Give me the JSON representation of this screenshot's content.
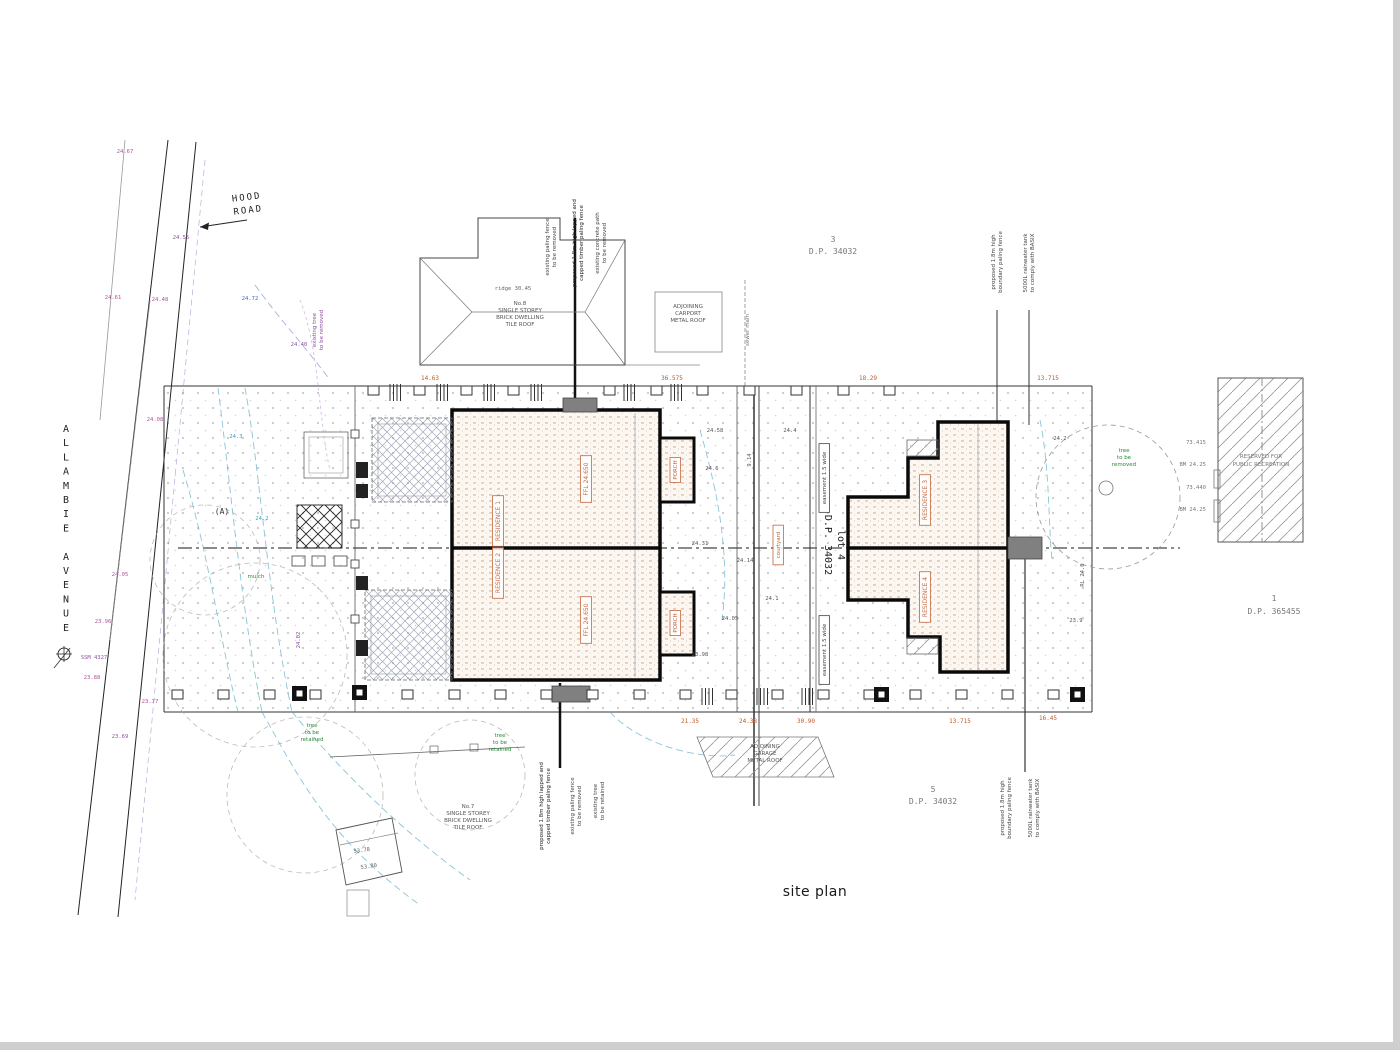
{
  "title": {
    "text": "site plan"
  },
  "streets": {
    "avenue": "ALLAMBIE AVENUE"
  },
  "colors": {
    "outline": "#0a0a0a",
    "orange": "#c05a28",
    "unit_label": "#c2683f",
    "magenta": "#b0509a",
    "purple": "#8a4f9e",
    "green": "#2a8a3a",
    "cyan": "#3aa0b8",
    "gray": "#555555"
  },
  "blocks": [
    {
      "n": "street-name-allambie-avenue",
      "lines": [
        "A",
        "L",
        "L",
        "A",
        "M",
        "B",
        "I",
        "E",
        " ",
        "A",
        "V",
        "E",
        "N",
        "U",
        "E"
      ],
      "x": 66,
      "y": 432,
      "s": 10,
      "lh": 14.2,
      "c": "#222",
      "f": "mono"
    },
    {
      "n": "road-name",
      "lines": [
        "HOOD",
        "ROAD"
      ],
      "x": 247,
      "y": 200,
      "s": 9,
      "lh": 13,
      "c": "#222",
      "r": -7,
      "ls": 2,
      "f": "mono"
    },
    {
      "n": "lot-3-label",
      "lines": [
        "3",
        "D.P. 34032"
      ],
      "x": 833,
      "y": 242,
      "s": 8,
      "lh": 12,
      "c": "#777",
      "f": "mono"
    },
    {
      "n": "lot-5-label",
      "lines": [
        "5",
        "D.P. 34032"
      ],
      "x": 933,
      "y": 792,
      "s": 8,
      "lh": 12,
      "c": "#777",
      "f": "mono"
    },
    {
      "n": "lot-1-label",
      "lines": [
        "1",
        "D.P. 365455"
      ],
      "x": 1274,
      "y": 601,
      "s": 8,
      "lh": 13,
      "c": "#777",
      "f": "mono"
    },
    {
      "n": "lot-4-label",
      "lines": [
        "lot 4",
        "D.P. 34032"
      ],
      "x": 838,
      "y": 545,
      "s": 10,
      "lh": 13,
      "c": "#222",
      "r": 90,
      "f": "mono"
    },
    {
      "n": "house-no8-label",
      "lines": [
        "No.8",
        "SINGLE STOREY",
        "BRICK DWELLING",
        "TILE ROOF"
      ],
      "x": 520,
      "y": 305,
      "s": 5.5,
      "lh": 7,
      "c": "#555"
    },
    {
      "n": "carport-label",
      "lines": [
        "ADJOINING",
        "CARPORT",
        "METAL ROOF"
      ],
      "x": 688,
      "y": 308,
      "s": 5.5,
      "lh": 7,
      "c": "#555"
    },
    {
      "n": "neighbour-garage-label",
      "lines": [
        "ADJOINING",
        "GARAGE",
        "METAL ROOF"
      ],
      "x": 765,
      "y": 748,
      "s": 5.5,
      "lh": 7,
      "c": "#555"
    },
    {
      "n": "house-no7-label",
      "lines": [
        "No.7",
        "SINGLE STOREY",
        "BRICK DWELLING",
        "TILE ROOF"
      ],
      "x": 468,
      "y": 808,
      "s": 5.5,
      "lh": 7,
      "c": "#555"
    },
    {
      "n": "reserve-label",
      "lines": [
        "RESERVED FOR",
        "PUBLIC RECREATION"
      ],
      "x": 1261,
      "y": 458,
      "s": 5.5,
      "lh": 8,
      "c": "#777"
    },
    {
      "n": "tree-label-1",
      "lines": [
        "tree",
        "to be",
        "removed"
      ],
      "x": 1124,
      "y": 452,
      "s": 5.5,
      "lh": 7,
      "c": "#2a8a3a"
    },
    {
      "n": "tree-label-2",
      "lines": [
        "tree",
        "to be",
        "retained"
      ],
      "x": 312,
      "y": 727,
      "s": 5.5,
      "lh": 7,
      "c": "#2a8a3a"
    },
    {
      "n": "tree-label-3",
      "lines": [
        "tree",
        "to be",
        "retained"
      ],
      "x": 500,
      "y": 737,
      "s": 5.5,
      "lh": 7,
      "c": "#2a8a3a"
    },
    {
      "n": "annotation-fence-top-1",
      "lines": [
        "existing paling fence",
        "to be removed"
      ],
      "x": 549,
      "y": 247,
      "s": 5.5,
      "lh": 7,
      "c": "#444",
      "r": -90
    },
    {
      "n": "annotation-fence-top-2",
      "lines": [
        "proposed 1.8m high lapped and",
        "capped timber paling fence"
      ],
      "x": 576,
      "y": 243,
      "s": 5.5,
      "lh": 7,
      "c": "#222",
      "r": -90
    },
    {
      "n": "annotation-path-top",
      "lines": [
        "existing concrete path",
        "to be removed"
      ],
      "x": 599,
      "y": 243,
      "s": 5.5,
      "lh": 7,
      "c": "#444",
      "r": -90
    },
    {
      "n": "annotation-fence-ne-1",
      "lines": [
        "proposed 1.8m high",
        "boundary paling fence"
      ],
      "x": 995,
      "y": 262,
      "s": 5.5,
      "lh": 7,
      "c": "#444",
      "r": -90
    },
    {
      "n": "annotation-tank-ne",
      "lines": [
        "5000L rainwater tank",
        "to comply with BASIX"
      ],
      "x": 1027,
      "y": 263,
      "s": 5.5,
      "lh": 7,
      "c": "#444",
      "r": -90
    },
    {
      "n": "annotation-fence-sw-1",
      "lines": [
        "proposed 1.8m high lapped and",
        "capped timber paling fence"
      ],
      "x": 543,
      "y": 806,
      "s": 5.5,
      "lh": 7,
      "c": "#222",
      "r": -90
    },
    {
      "n": "annotation-fence-sw-2",
      "lines": [
        "existing paling fence",
        "to be removed"
      ],
      "x": 574,
      "y": 806,
      "s": 5.5,
      "lh": 7,
      "c": "#444",
      "r": -90
    },
    {
      "n": "annotation-tree-sw",
      "lines": [
        "existing tree",
        "to be retained"
      ],
      "x": 597,
      "y": 801,
      "s": 5.5,
      "lh": 7,
      "c": "#444",
      "r": -90
    },
    {
      "n": "annotation-fence-se-1",
      "lines": [
        "proposed 1.8m high",
        "boundary paling fence"
      ],
      "x": 1004,
      "y": 808,
      "s": 5.5,
      "lh": 7,
      "c": "#444",
      "r": -90
    },
    {
      "n": "annotation-tank-se",
      "lines": [
        "5000L rainwater tank",
        "to comply with BASIX"
      ],
      "x": 1032,
      "y": 808,
      "s": 5.5,
      "lh": 7,
      "c": "#444",
      "r": -90
    },
    {
      "n": "annotation-tree-w",
      "lines": [
        "existing tree",
        "to be removed"
      ],
      "x": 316,
      "y": 330,
      "s": 5.5,
      "lh": 7,
      "c": "#8a4f9e",
      "r": -90
    },
    {
      "n": "annotation-sewer",
      "lines": [
        "sewer main"
      ],
      "x": 749,
      "y": 330,
      "s": 5.5,
      "lh": 7,
      "c": "#777",
      "r": -90
    }
  ],
  "labels": [
    {
      "n": "dim",
      "t": "14.63",
      "x": 430,
      "y": 380,
      "c": "#c05a28",
      "s": 6,
      "f": "mono"
    },
    {
      "n": "dim",
      "t": "36.575",
      "x": 672,
      "y": 380,
      "c": "#c05a28",
      "s": 6,
      "f": "mono"
    },
    {
      "n": "dim",
      "t": "18.29",
      "x": 868,
      "y": 380,
      "c": "#c05a28",
      "s": 6,
      "f": "mono"
    },
    {
      "n": "dim",
      "t": "13.715",
      "x": 1048,
      "y": 380,
      "c": "#c05a28",
      "s": 6,
      "f": "mono"
    },
    {
      "n": "dim",
      "t": "21.35",
      "x": 690,
      "y": 723,
      "c": "#c05a28",
      "s": 6,
      "f": "mono"
    },
    {
      "n": "dim",
      "t": "24.38",
      "x": 748,
      "y": 723,
      "c": "#c05a28",
      "s": 6,
      "f": "mono"
    },
    {
      "n": "dim",
      "t": "30.90",
      "x": 806,
      "y": 723,
      "c": "#c05a28",
      "s": 6,
      "f": "mono"
    },
    {
      "n": "dim",
      "t": "13.715",
      "x": 960,
      "y": 723,
      "c": "#c05a28",
      "s": 6,
      "f": "mono"
    },
    {
      "n": "dim",
      "t": "16.45",
      "x": 1048,
      "y": 720,
      "c": "#c05a28",
      "s": 6,
      "f": "mono"
    },
    {
      "n": "dim",
      "t": "9.14",
      "x": 751,
      "y": 460,
      "c": "#555",
      "s": 5.5,
      "r": -90,
      "f": "mono"
    },
    {
      "n": "spot-level",
      "t": "24.58",
      "x": 715,
      "y": 432,
      "c": "#555",
      "s": 5.5,
      "f": "mono"
    },
    {
      "n": "spot-level",
      "t": "24.6",
      "x": 712,
      "y": 470,
      "c": "#555",
      "s": 5.5,
      "f": "mono"
    },
    {
      "n": "spot-level",
      "t": "24.31",
      "x": 700,
      "y": 545,
      "c": "#555",
      "s": 5.5,
      "f": "mono"
    },
    {
      "n": "spot-level",
      "t": "24.14",
      "x": 745,
      "y": 562,
      "c": "#555",
      "s": 5.5,
      "f": "mono"
    },
    {
      "n": "spot-level",
      "t": "24.05",
      "x": 730,
      "y": 620,
      "c": "#555",
      "s": 5.5,
      "f": "mono"
    },
    {
      "n": "spot-level",
      "t": "23.98",
      "x": 700,
      "y": 656,
      "c": "#555",
      "s": 5.5,
      "f": "mono"
    },
    {
      "n": "spot-level",
      "t": "24.1",
      "x": 772,
      "y": 600,
      "c": "#555",
      "s": 5.5,
      "f": "mono"
    },
    {
      "n": "spot-level",
      "t": "24.4",
      "x": 790,
      "y": 432,
      "c": "#555",
      "s": 5.5,
      "f": "mono"
    },
    {
      "n": "spot-level",
      "t": "24.2",
      "x": 1060,
      "y": 440,
      "c": "#555",
      "s": 5.5,
      "f": "mono"
    },
    {
      "n": "spot-level",
      "t": "23.9",
      "x": 1076,
      "y": 622,
      "c": "#555",
      "s": 5.5,
      "f": "mono"
    },
    {
      "n": "spot-level",
      "t": "RL 24.0",
      "x": 1084,
      "y": 575,
      "c": "#555",
      "s": 5.5,
      "r": -90,
      "f": "mono"
    },
    {
      "n": "spot-level",
      "t": "53.78",
      "x": 362,
      "y": 852,
      "c": "#666",
      "s": 5.5,
      "r": -8,
      "f": "mono"
    },
    {
      "n": "spot-level",
      "t": "53.80",
      "x": 369,
      "y": 868,
      "c": "#666",
      "s": 5.5,
      "r": -8,
      "f": "mono"
    },
    {
      "n": "bench-mark",
      "t": "73.415",
      "x": 1206,
      "y": 444,
      "c": "#777",
      "s": 5.5,
      "a": "end",
      "f": "mono"
    },
    {
      "n": "bench-mark",
      "t": "BM 24.25",
      "x": 1206,
      "y": 466,
      "c": "#777",
      "s": 5.5,
      "a": "end",
      "f": "mono"
    },
    {
      "n": "bench-mark",
      "t": "73.440",
      "x": 1206,
      "y": 489,
      "c": "#777",
      "s": 5.5,
      "a": "end",
      "f": "mono"
    },
    {
      "n": "bench-mark",
      "t": "BM 24.25",
      "x": 1206,
      "y": 511,
      "c": "#777",
      "s": 5.5,
      "a": "end",
      "f": "mono"
    },
    {
      "n": "point-a",
      "t": "(A)",
      "x": 222,
      "y": 514,
      "c": "#333",
      "s": 8,
      "f": "mono"
    },
    {
      "n": "survey-mark",
      "t": "SSM 4327",
      "x": 94,
      "y": 659,
      "c": "#8a4f9e",
      "s": 5.5,
      "f": "mono"
    },
    {
      "n": "ridge-level",
      "t": "ridge 30.45",
      "x": 513,
      "y": 290,
      "c": "#666",
      "s": 5.5,
      "f": "mono"
    },
    {
      "n": "road-level",
      "t": "24.67",
      "x": 125,
      "y": 153,
      "c": "#b0509a",
      "s": 5.5,
      "f": "mono"
    },
    {
      "n": "road-level",
      "t": "24.61",
      "x": 113,
      "y": 299,
      "c": "#b0509a",
      "s": 5.5,
      "f": "mono"
    },
    {
      "n": "road-level",
      "t": "24.55",
      "x": 181,
      "y": 239,
      "c": "#8a4f9e",
      "s": 5.5,
      "f": "mono"
    },
    {
      "n": "road-level",
      "t": "24.48",
      "x": 160,
      "y": 301,
      "c": "#b0509a",
      "s": 5.5,
      "f": "mono"
    },
    {
      "n": "road-level",
      "t": "24.40",
      "x": 299,
      "y": 346,
      "c": "#8a4f9e",
      "s": 5.5,
      "f": "mono"
    },
    {
      "n": "road-level",
      "t": "24.72",
      "x": 250,
      "y": 300,
      "c": "#3a6fba",
      "s": 5.5,
      "f": "mono"
    },
    {
      "n": "road-level",
      "t": "24.08",
      "x": 155,
      "y": 421,
      "c": "#b0509a",
      "s": 5.5,
      "f": "mono"
    },
    {
      "n": "road-level",
      "t": "24.05",
      "x": 120,
      "y": 576,
      "c": "#b0509a",
      "s": 5.5,
      "f": "mono"
    },
    {
      "n": "road-level",
      "t": "23.96",
      "x": 103,
      "y": 623,
      "c": "#b0509a",
      "s": 5.5,
      "f": "mono"
    },
    {
      "n": "road-level",
      "t": "23.88",
      "x": 92,
      "y": 679,
      "c": "#b0509a",
      "s": 5.5,
      "f": "mono"
    },
    {
      "n": "road-level",
      "t": "23.77",
      "x": 150,
      "y": 703,
      "c": "#b0509a",
      "s": 5.5,
      "f": "mono"
    },
    {
      "n": "road-level",
      "t": "23.69",
      "x": 120,
      "y": 738,
      "c": "#8a4f9e",
      "s": 5.5,
      "f": "mono"
    },
    {
      "n": "road-level",
      "t": "24.02",
      "x": 300,
      "y": 640,
      "c": "#8a4f9e",
      "s": 5.5,
      "r": -90,
      "f": "mono"
    },
    {
      "n": "contour-value",
      "t": "24.3",
      "x": 236,
      "y": 438,
      "c": "#3aa0b8",
      "s": 5.5,
      "f": "mono"
    },
    {
      "n": "contour-value",
      "t": "24.2",
      "x": 262,
      "y": 520,
      "c": "#3aa0b8",
      "s": 5.5,
      "f": "mono"
    },
    {
      "n": "landscape-note",
      "t": "mulch",
      "x": 256,
      "y": 578,
      "c": "#2a8a3a",
      "s": 5.5
    }
  ],
  "boxed": [
    {
      "n": "unit-label-residence-1",
      "t": "RESIDENCE 1",
      "x": 500,
      "y": 521,
      "r": -90,
      "c": "#c2683f",
      "s": 6
    },
    {
      "n": "ffl-label-1",
      "t": "FFL 24.650",
      "x": 588,
      "y": 479,
      "r": -90,
      "c": "#c2683f",
      "s": 6
    },
    {
      "n": "unit-label-residence-2",
      "t": "RESIDENCE 2",
      "x": 500,
      "y": 573,
      "r": -90,
      "c": "#c2683f",
      "s": 6
    },
    {
      "n": "ffl-label-2",
      "t": "FFL 24.650",
      "x": 588,
      "y": 620,
      "r": -90,
      "c": "#c2683f",
      "s": 6
    },
    {
      "n": "porch-label-1",
      "t": "PORCH",
      "x": 677,
      "y": 470,
      "r": -90,
      "c": "#c2683f",
      "s": 5.5
    },
    {
      "n": "porch-label-2",
      "t": "PORCH",
      "x": 677,
      "y": 623,
      "r": -90,
      "c": "#c2683f",
      "s": 5.5
    },
    {
      "n": "unit-label-residence-3",
      "t": "RESIDENCE 3",
      "x": 927,
      "y": 500,
      "r": -90,
      "c": "#c2683f",
      "s": 6
    },
    {
      "n": "unit-label-residence-4",
      "t": "RESIDENCE 4",
      "x": 927,
      "y": 597,
      "r": -90,
      "c": "#c2683f",
      "s": 6
    },
    {
      "n": "easement-label-1",
      "t": "easement 1.5 wide",
      "x": 826,
      "y": 478,
      "r": -90,
      "c": "#444",
      "s": 5.5
    },
    {
      "n": "easement-label-2",
      "t": "easement 1.5 wide",
      "x": 826,
      "y": 650,
      "r": -90,
      "c": "#444",
      "s": 5.5
    },
    {
      "n": "courtyard-label",
      "t": "courtyard",
      "x": 780,
      "y": 545,
      "r": -90,
      "c": "#c2683f",
      "s": 5.5
    }
  ]
}
